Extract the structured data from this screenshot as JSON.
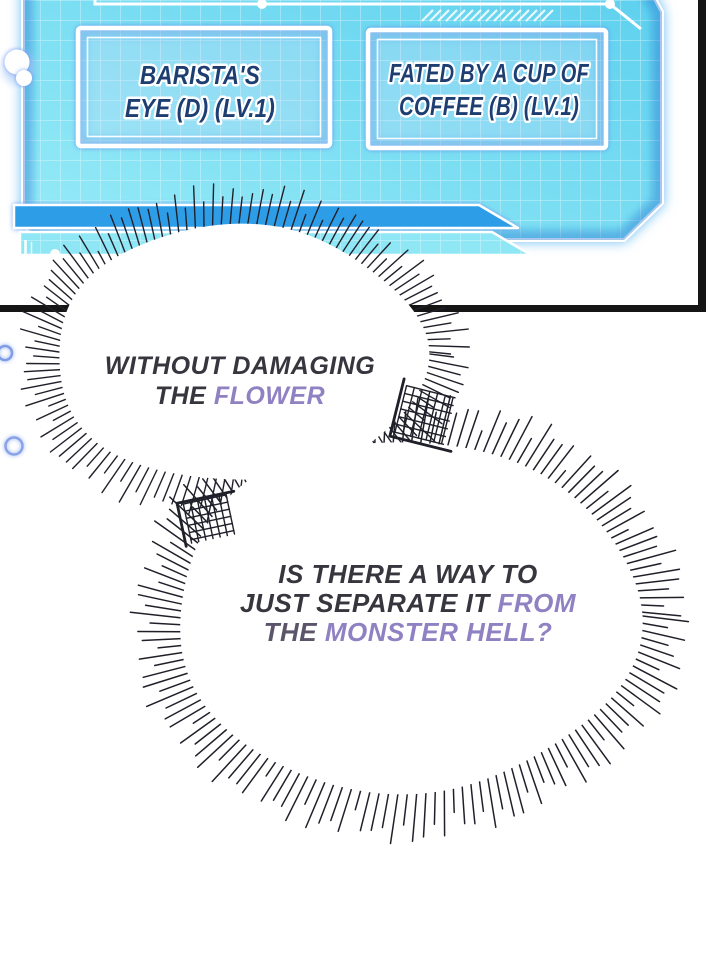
{
  "hud": {
    "box1": {
      "line1": "BARISTA'S",
      "line2": "EYE (D) (LV.1)"
    },
    "box2": {
      "line1": "FATED BY A CUP OF",
      "line2": "COFFEE (B) (LV.1)"
    }
  },
  "bubbles": {
    "bubble1": {
      "line1": "WITHOUT DAMAGING",
      "line2_dark": "THE ",
      "line2_accent": "FLOWER"
    },
    "bubble2": {
      "line1": "IS THERE A WAY TO",
      "line2_dark": "JUST SEPARATE IT ",
      "line2_accent": "FROM",
      "line3_mid": "THE ",
      "line3_accent": "MONSTER HELL?"
    }
  },
  "colors": {
    "hud_cyan_light": "#97ebf7",
    "hud_cyan_deep": "#5bcfee",
    "hud_stripe_blue": "#2e9de8",
    "hud_label_navy": "#1e3e72",
    "panel_border_black": "#151515",
    "spike_ink": "#20202a",
    "bubble_text_dark": "#37353d",
    "bubble_text_purple": "#8f81c2",
    "bubble_text_purple_dim": "#5c5469",
    "glow_blue": "#5a8fe8"
  }
}
